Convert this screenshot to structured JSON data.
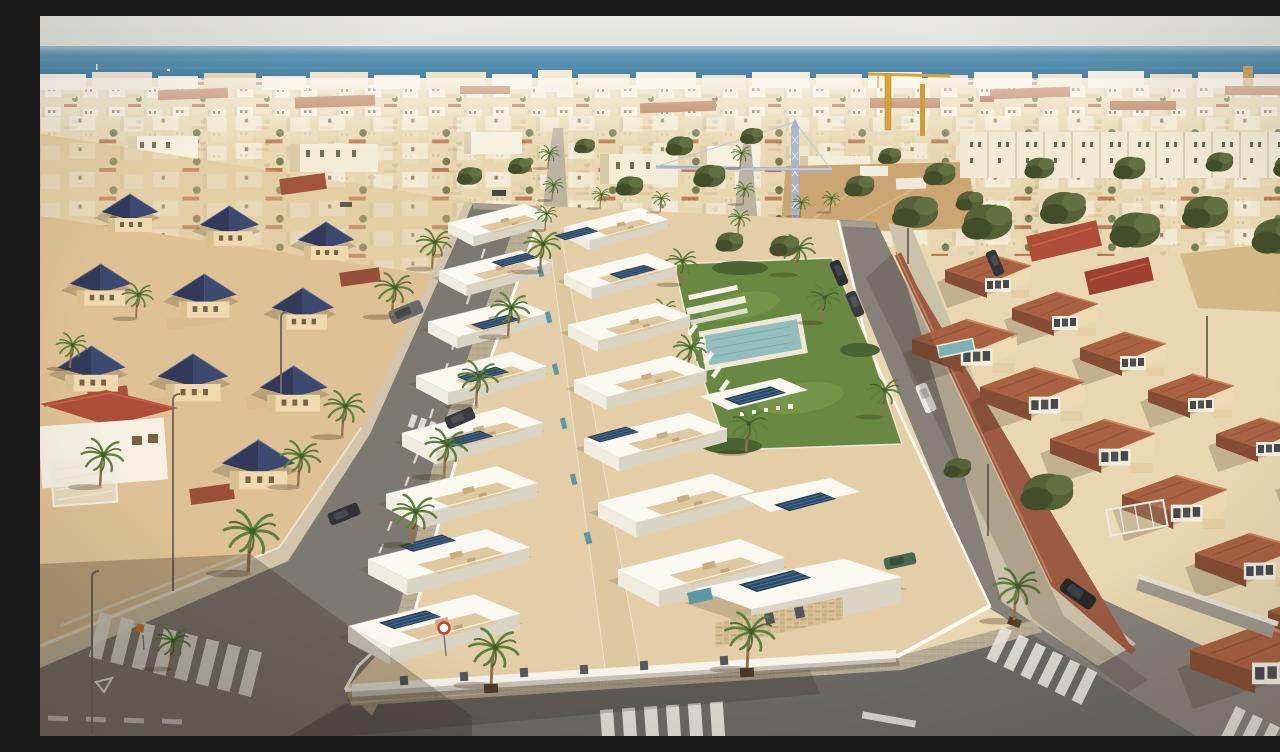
{
  "scene": {
    "description": "Aerial drone view at golden hour of a coastal residential area: a new development of modern white flat-roofed villas with rooftop solar panels and a communal lawn with swimming pool, flanked on the left by an older neighbourhood of cream villas with dark navy pyramid roofs and on the right by a street of two-storey terracotta-roofed townhouses; behind them a dense low-rise town, two construction cranes, a vacant sandy lot, palm-lined streets with zebra crossings, and the blue Mediterranean sea under a pale hazy sky on the horizon.",
    "labels": {
      "sky": "pale hazy sky",
      "sea": "Mediterranean sea on the horizon",
      "town": "dense low-rise coastal town",
      "craneBlue": "blue lattice tower crane",
      "craneYellow": "yellow tower crane",
      "vacantLot": "vacant sandy construction lot",
      "oldTown": "older neighbourhood with navy pyramid roofs",
      "development": "new development of white villas with solar panels",
      "poolGarden": "communal lawn with swimming pool and sun loungers",
      "terracottaRow": "street of terracotta-roofed townhouses",
      "roads": "asphalt streets with zebra crossings",
      "palms": "palm trees lining the sidewalks"
    }
  },
  "colors": {
    "skyTop": "#ebebe7",
    "skyBottom": "#dfe5e5",
    "seaHaze": "#9fbecd",
    "seaTop": "#5590b2",
    "seaMid": "#4284ab",
    "seaBottom": "#366f99",
    "townBase": "#e7d7b0",
    "townWhite": "#f6f0e0",
    "roofTerracotta": "#ad6640",
    "treeGreen": "#49582e",
    "palmGreen": "#4f7a33",
    "palmDark": "#33511f",
    "palmTrunk": "#8a6a48",
    "sandLot": "#c8a26e",
    "craneBlue": "#9fb0d0",
    "craneYellow": "#d79f2e",
    "navyRoofLight": "#2f3f6b",
    "navyRoofDark": "#232e52",
    "creamWall": "#eed9ae",
    "redRoof": "#a8432f",
    "asphaltA": "#75716b",
    "asphaltC": "#7d7974",
    "asphaltDark": "#615f5e",
    "paver": "#b2a790",
    "sidewalkLight": "#cfc3aa",
    "devGround": "#e2cda6",
    "villaWhite": "#fbfaf5",
    "villaShadow": "#d8d3c6",
    "terraceBeige": "#dcc69e",
    "solarBlue": "#1d3e61",
    "solarGrid": "#3f6f9f",
    "accentTeal": "#4f93a3",
    "lawn": "#5e8238",
    "poolTeal": "#8bbcbe",
    "white": "#f4f2ea",
    "tcRoof": "#a2593a",
    "tcRoofDark": "#7c4229",
    "tcRoofLight": "#c8825a",
    "tcWall": "#ecd9b2",
    "brick": "#94503a",
    "carDark": "#23262e",
    "carWhite": "#e9eae8",
    "wallWhite": "#fdfcf6"
  }
}
